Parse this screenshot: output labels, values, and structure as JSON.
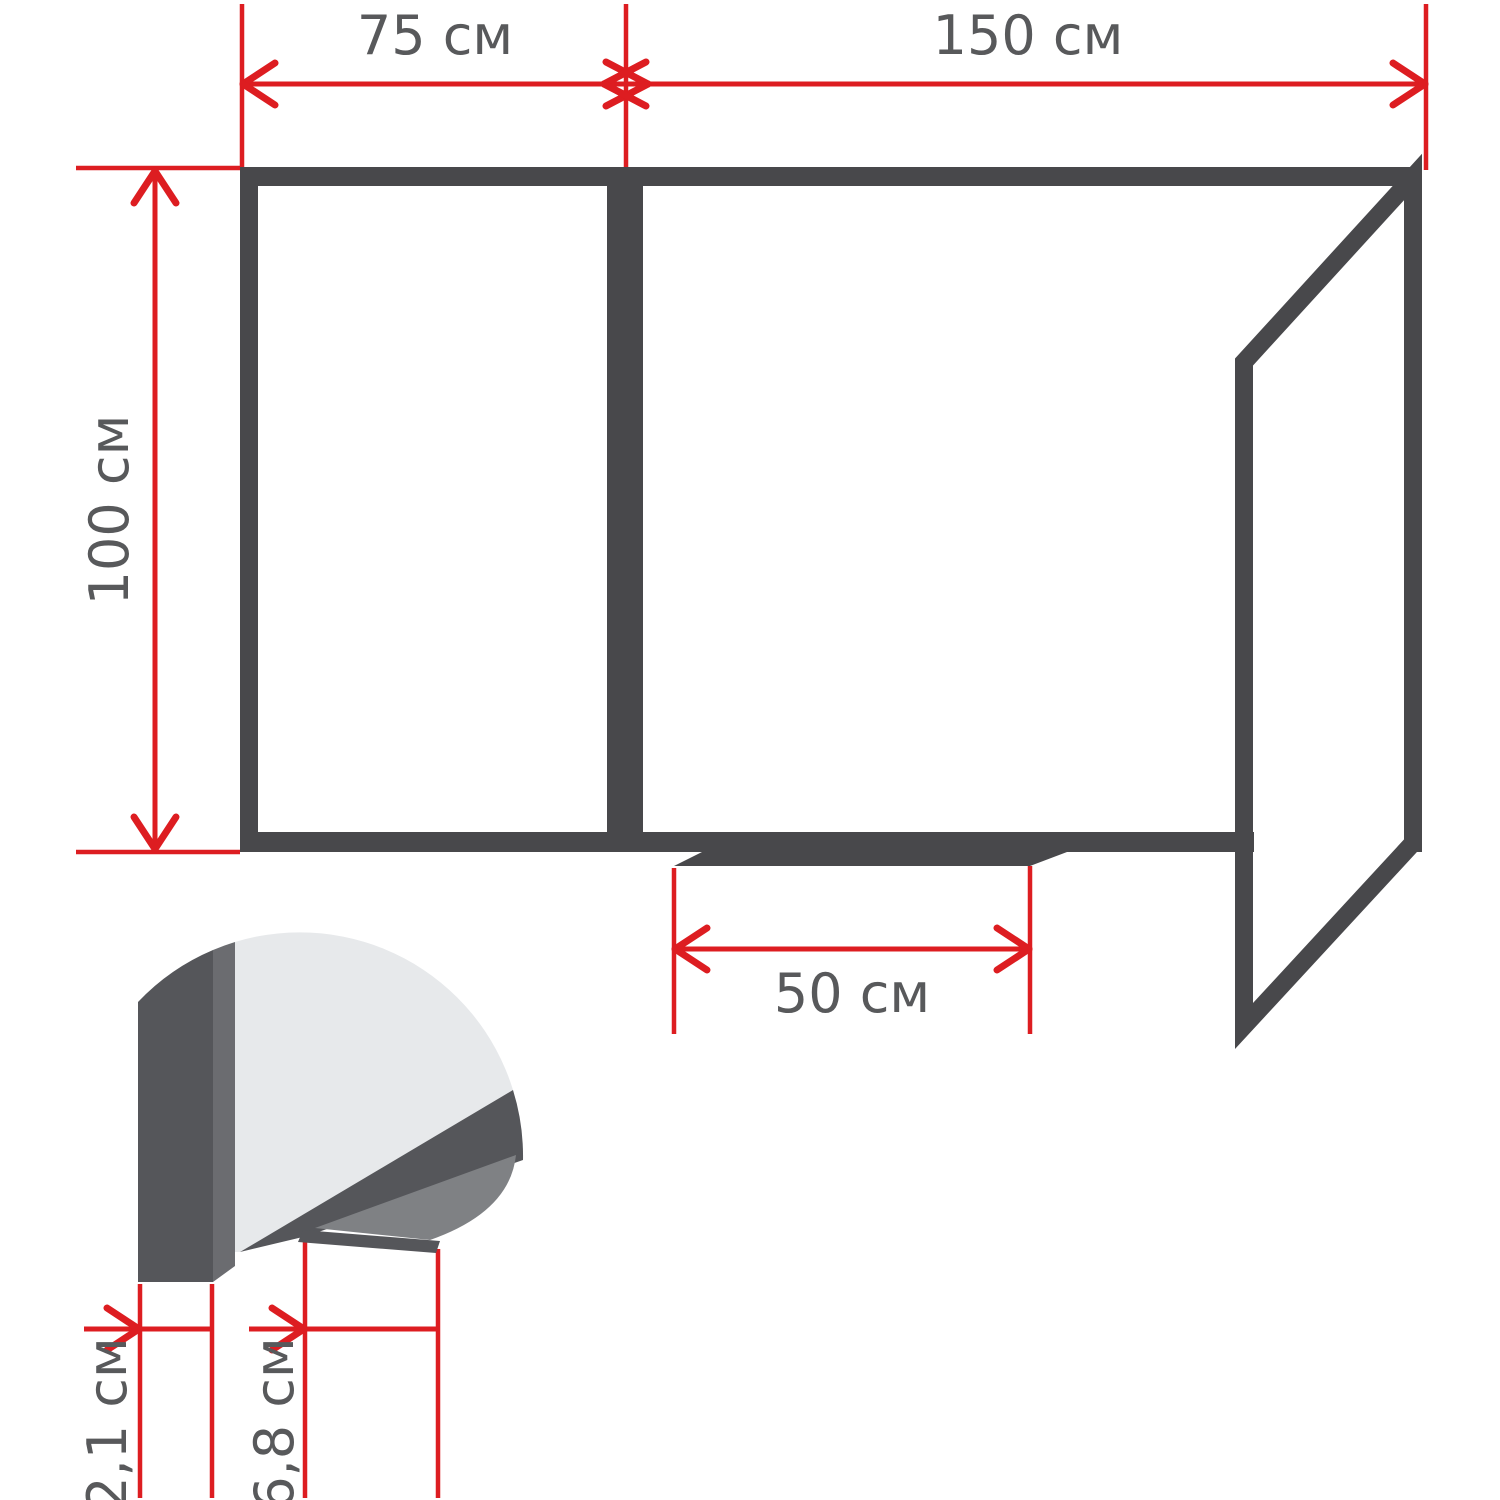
{
  "diagram": {
    "kind": "whiteboard-dimension-drawing",
    "units": "см",
    "labels": {
      "left_panel_width": "75 см",
      "main_panel_width": "150 см",
      "board_height": "100 см",
      "tray_width": "50 см",
      "profile_thickness": "2,1 см",
      "tray_depth": "6,8 см"
    },
    "colors": {
      "frame_dark": "#48484b",
      "dimension_red": "#dd1d21",
      "label_text": "#58595b",
      "board_face_light": "#e7e9eb",
      "profile_slab": "#55565a",
      "profile_edge": "#6b6c70",
      "tray_wedge": "#7f8184"
    }
  }
}
